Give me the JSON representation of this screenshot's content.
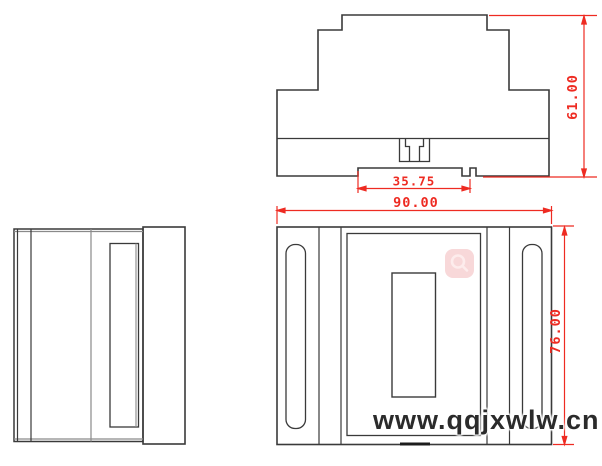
{
  "page": {
    "type": "technical-drawing",
    "background": "#ffffff",
    "views": [
      {
        "id": "side-profile",
        "label": "DIN-rail enclosure side profile view"
      },
      {
        "id": "left-side",
        "label": "enclosure left side view"
      },
      {
        "id": "front",
        "label": "enclosure front view"
      }
    ],
    "dimensions": [
      {
        "id": "overall-height",
        "value": "61.00",
        "orientation": "vertical",
        "view": "side-profile"
      },
      {
        "id": "din-channel-width",
        "value": "35.75",
        "orientation": "horizontal",
        "view": "side-profile"
      },
      {
        "id": "overall-width",
        "value": "90.00",
        "orientation": "horizontal",
        "view": "front"
      },
      {
        "id": "front-height",
        "value": "76.00",
        "orientation": "vertical",
        "view": "front"
      }
    ],
    "watermark": {
      "text": "www.qqjxwlw.cn",
      "icon": "magnifier-icon",
      "icon_bg": "#f8d8d9",
      "icon_glyph_color": "#fdecec",
      "text_color": "#2b2b2b"
    },
    "colors": {
      "dimension_red": "#ee2b22",
      "outline_dark": "#3a3a3a",
      "outline_gray": "#8a8a8a"
    }
  }
}
